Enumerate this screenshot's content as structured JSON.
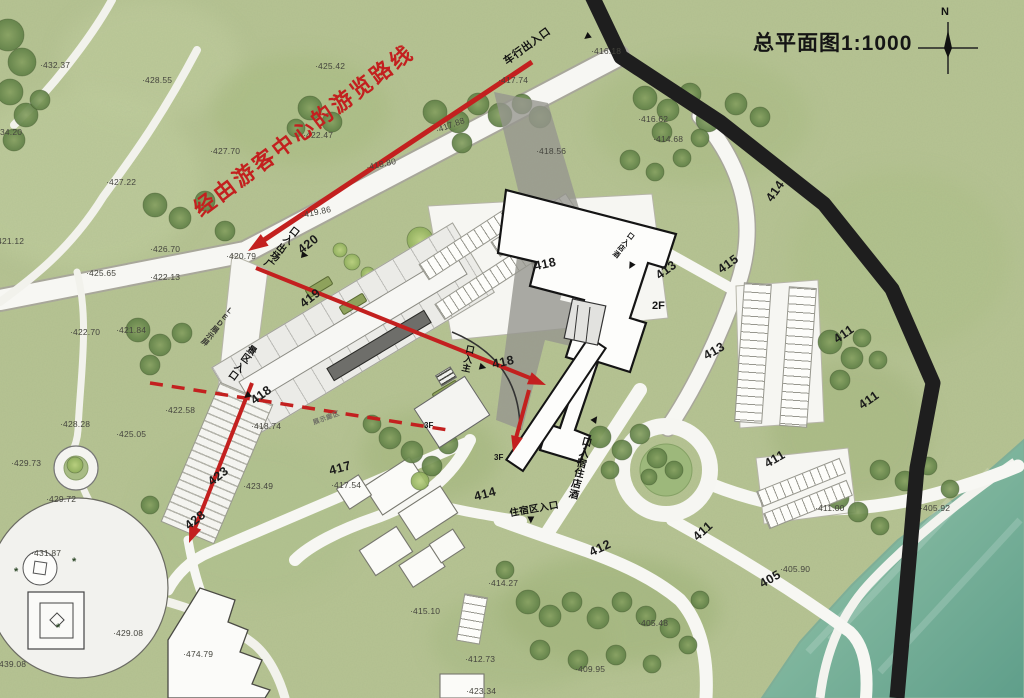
{
  "title": "总平面图1:1000",
  "compass_label": "N",
  "route_annotation": "经由游客中心的游览路线",
  "colors": {
    "route_red": "#c3201f",
    "road_black": "#1e1e1e",
    "base_green": "#b7c493",
    "lake_from": "#9ac4ab",
    "lake_to": "#5f9e8a"
  },
  "entrance_labels": [
    {
      "text": "车行出入口",
      "x": 527,
      "y": 46,
      "rot": -36,
      "mode": "h",
      "size": 10.5,
      "tri": {
        "x": 587,
        "y": 37,
        "rot": 142
      }
    },
    {
      "text": "广场出入口",
      "x": 281,
      "y": 249,
      "rot": 38,
      "mode": "v",
      "reversed": true,
      "size": 9.5,
      "tri": {
        "x": 305,
        "y": 255,
        "rot": 10
      }
    },
    {
      "text": "景区入口",
      "x": 242,
      "y": 364,
      "rot": 36,
      "mode": "v",
      "reversed": false,
      "size": 9.5,
      "tri": {
        "x": 247,
        "y": 396,
        "rot": 142
      }
    },
    {
      "text": "主入口",
      "x": 468,
      "y": 360,
      "rot": 12,
      "mode": "v",
      "reversed": true,
      "size": 9,
      "tri": {
        "x": 483,
        "y": 367,
        "rot": 15
      }
    },
    {
      "text": "酒店入口",
      "x": 623,
      "y": 246,
      "rot": 38,
      "mode": "v",
      "reversed": true,
      "size": 7,
      "tri": {
        "x": 631,
        "y": 266,
        "rot": 120
      }
    },
    {
      "text": "酒店住宿入口",
      "x": 580,
      "y": 470,
      "rot": 14,
      "mode": "v",
      "reversed": true,
      "size": 10,
      "tri": {
        "x": 595,
        "y": 419,
        "rot": -55
      }
    },
    {
      "text": "住宿区入口",
      "x": 534,
      "y": 508,
      "rot": -10,
      "mode": "h",
      "size": 9.5,
      "tri": {
        "x": 531,
        "y": 520,
        "rot": 90
      }
    },
    {
      "text": "LED展示屏",
      "x": 217,
      "y": 327,
      "rot": 38,
      "mode": "v",
      "size": 7.5,
      "color": "#3a3a35"
    },
    {
      "text": "展示廊区",
      "x": 326,
      "y": 417,
      "rot": -20,
      "mode": "h",
      "size": 6.5,
      "color": "#6f6f66"
    }
  ],
  "road_labels": [
    {
      "text": "420",
      "x": 297,
      "y": 237,
      "rot": -38
    },
    {
      "text": "419",
      "x": 299,
      "y": 291,
      "rot": -38
    },
    {
      "text": "418",
      "x": 534,
      "y": 257,
      "rot": -12
    },
    {
      "text": "418",
      "x": 492,
      "y": 355,
      "rot": -12
    },
    {
      "text": "418",
      "x": 250,
      "y": 388,
      "rot": -36
    },
    {
      "text": "423",
      "x": 207,
      "y": 469,
      "rot": -38
    },
    {
      "text": "428",
      "x": 184,
      "y": 513,
      "rot": -38
    },
    {
      "text": "417",
      "x": 329,
      "y": 461,
      "rot": -15
    },
    {
      "text": "414",
      "x": 474,
      "y": 487,
      "rot": -15
    },
    {
      "text": "412",
      "x": 589,
      "y": 541,
      "rot": -25
    },
    {
      "text": "413",
      "x": 655,
      "y": 263,
      "rot": -36
    },
    {
      "text": "413",
      "x": 703,
      "y": 344,
      "rot": -30
    },
    {
      "text": "414",
      "x": 764,
      "y": 184,
      "rot": -55
    },
    {
      "text": "415",
      "x": 717,
      "y": 257,
      "rot": -36
    },
    {
      "text": "411",
      "x": 833,
      "y": 327,
      "rot": -35
    },
    {
      "text": "411",
      "x": 858,
      "y": 393,
      "rot": -35
    },
    {
      "text": "411",
      "x": 764,
      "y": 452,
      "rot": -30
    },
    {
      "text": "411",
      "x": 692,
      "y": 524,
      "rot": -42
    },
    {
      "text": "405",
      "x": 759,
      "y": 572,
      "rot": -30
    }
  ],
  "floor_labels": [
    {
      "text": "2F",
      "x": 652,
      "y": 300,
      "size": 11
    },
    {
      "text": "3F",
      "x": 424,
      "y": 421,
      "size": 8
    },
    {
      "text": "3F",
      "x": 494,
      "y": 453,
      "size": 8
    }
  ],
  "spot_elevations": [
    {
      "text": "·432.37",
      "x": 40,
      "y": 60
    },
    {
      "text": "·428.55",
      "x": 142,
      "y": 75
    },
    {
      "text": "·434.20",
      "x": -8,
      "y": 127
    },
    {
      "text": "·427.22",
      "x": 106,
      "y": 177
    },
    {
      "text": "·425.42",
      "x": 315,
      "y": 61
    },
    {
      "text": "·427.70",
      "x": 210,
      "y": 146
    },
    {
      "text": "·422.47",
      "x": 303,
      "y": 130
    },
    {
      "text": "·421.12",
      "x": -6,
      "y": 236
    },
    {
      "text": "·425.65",
      "x": 86,
      "y": 268
    },
    {
      "text": "·426.70",
      "x": 150,
      "y": 244
    },
    {
      "text": "·422.13",
      "x": 150,
      "y": 272
    },
    {
      "text": "·422.70",
      "x": 70,
      "y": 327
    },
    {
      "text": "·421.84",
      "x": 116,
      "y": 325
    },
    {
      "text": "·420.79",
      "x": 226,
      "y": 251
    },
    {
      "text": "·419.86",
      "x": 301,
      "y": 207,
      "rot": -12
    },
    {
      "text": "·418.80",
      "x": 366,
      "y": 159,
      "rot": -12
    },
    {
      "text": "·417.88",
      "x": 435,
      "y": 120,
      "rot": -20
    },
    {
      "text": "·416.18",
      "x": 591,
      "y": 46
    },
    {
      "text": "·417.74",
      "x": 498,
      "y": 75
    },
    {
      "text": "·418.56",
      "x": 536,
      "y": 146
    },
    {
      "text": "·416.62",
      "x": 638,
      "y": 114
    },
    {
      "text": "·414.68",
      "x": 653,
      "y": 134
    },
    {
      "text": "·422.58",
      "x": 165,
      "y": 405
    },
    {
      "text": "·418.74",
      "x": 251,
      "y": 421
    },
    {
      "text": "·423.49",
      "x": 243,
      "y": 481
    },
    {
      "text": "·417.54",
      "x": 331,
      "y": 480
    },
    {
      "text": "·428.28",
      "x": 60,
      "y": 419
    },
    {
      "text": "·425.05",
      "x": 116,
      "y": 429
    },
    {
      "text": "·429.73",
      "x": 11,
      "y": 458
    },
    {
      "text": "·429.72",
      "x": 46,
      "y": 494
    },
    {
      "text": "·431.87",
      "x": 31,
      "y": 548
    },
    {
      "text": "·429.08",
      "x": 113,
      "y": 628
    },
    {
      "text": "·439.08",
      "x": -4,
      "y": 659
    },
    {
      "text": "·474.79",
      "x": 183,
      "y": 649
    },
    {
      "text": "·414.27",
      "x": 488,
      "y": 578
    },
    {
      "text": "·415.10",
      "x": 410,
      "y": 606
    },
    {
      "text": "·412.73",
      "x": 465,
      "y": 654
    },
    {
      "text": "·409.95",
      "x": 575,
      "y": 664
    },
    {
      "text": "·405.48",
      "x": 638,
      "y": 618
    },
    {
      "text": "·405.90",
      "x": 780,
      "y": 564
    },
    {
      "text": "·405.92",
      "x": 920,
      "y": 503
    },
    {
      "text": "·411.00",
      "x": 815,
      "y": 503
    },
    {
      "text": "·423.34",
      "x": 466,
      "y": 686
    }
  ],
  "symbols": [
    {
      "glyph": "*",
      "x": 14,
      "y": 566
    },
    {
      "glyph": "*",
      "x": 56,
      "y": 622
    },
    {
      "glyph": "*",
      "x": 72,
      "y": 556
    }
  ]
}
